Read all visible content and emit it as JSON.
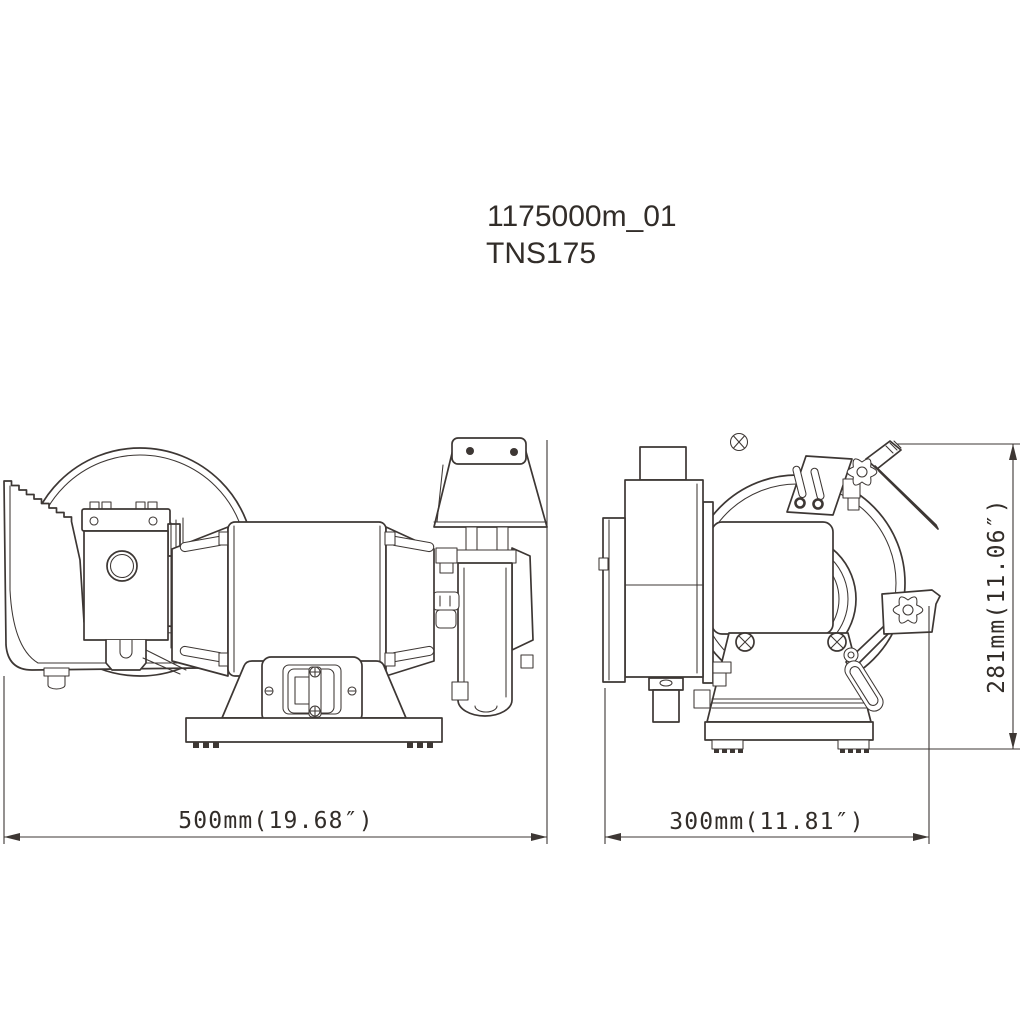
{
  "canvas": {
    "background": "#ffffff",
    "line_color": "#3d3734",
    "text_color": "#322d29"
  },
  "title_block": {
    "drawing_number": "1175000m_01",
    "model": "TNS175"
  },
  "dimensions": {
    "width": {
      "label": "500mm(19.68″)",
      "mm": 500,
      "inches": 19.68,
      "orientation": "horizontal",
      "view": "front"
    },
    "depth": {
      "label": "300mm(11.81″)",
      "mm": 300,
      "inches": 11.81,
      "orientation": "horizontal",
      "view": "side"
    },
    "height": {
      "label": "281mm(11.06″)",
      "mm": 281,
      "inches": 11.06,
      "orientation": "vertical",
      "view": "side"
    }
  }
}
